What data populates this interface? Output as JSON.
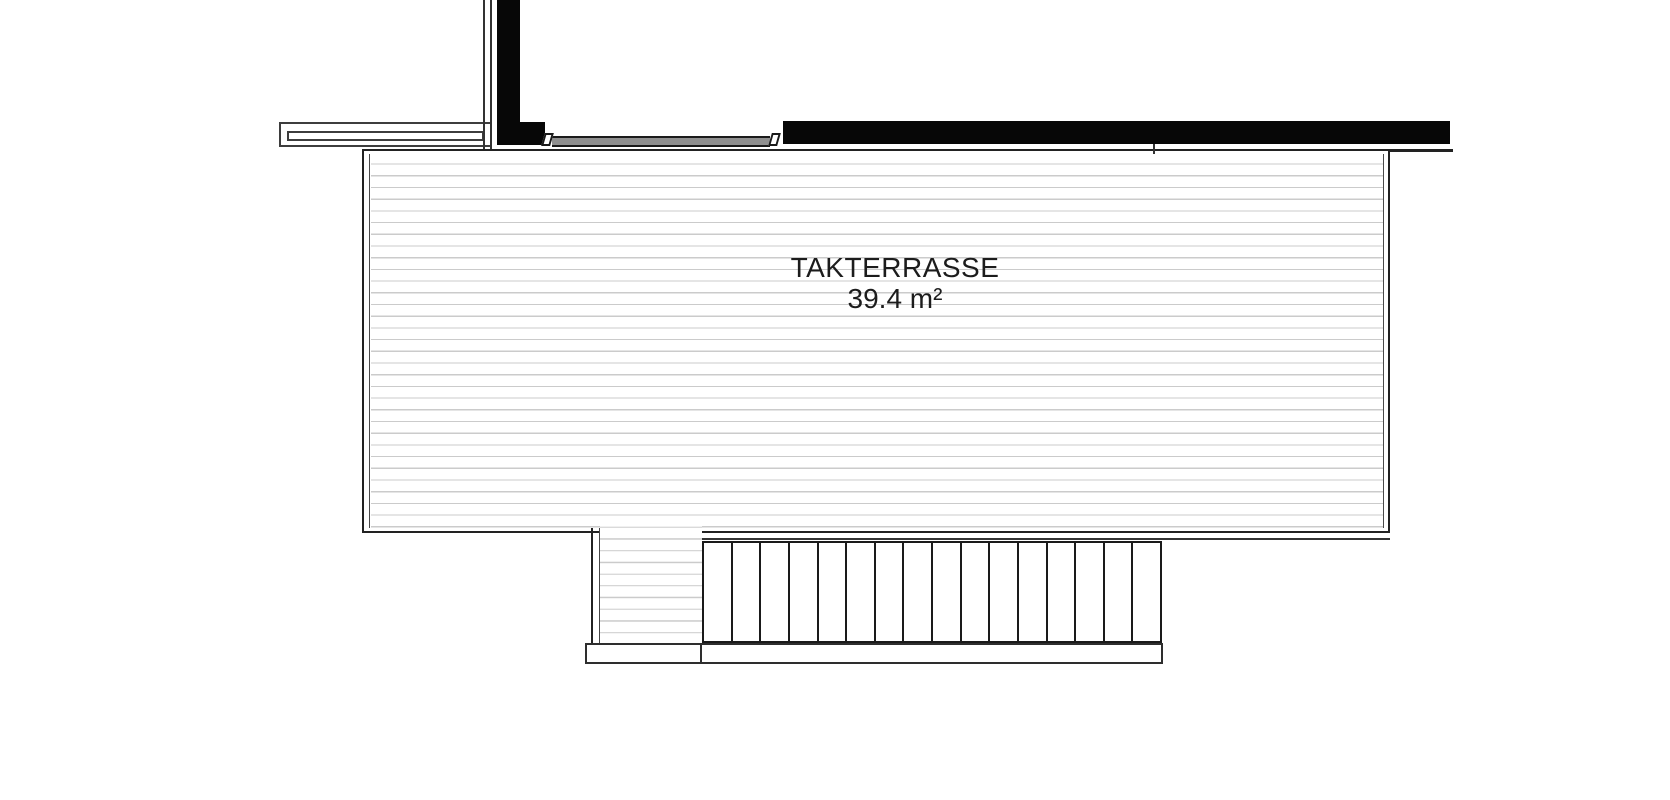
{
  "document": {
    "type": "architectural floor plan (roof terrace)",
    "background": "#ffffff"
  },
  "terrace": {
    "name_label": "TAKTERRASSE",
    "area_label": "39.4 m²"
  },
  "stairs": {
    "tread_count": 16
  },
  "colors": {
    "wall_fill": "#070707",
    "outline": "#1a1a1a",
    "railing_outline": "#3d3d3d",
    "deck_hatch_line": "#cbcbcb",
    "door_glass_fill": "#8f8f8f",
    "label_text": "#1c1c1c"
  }
}
